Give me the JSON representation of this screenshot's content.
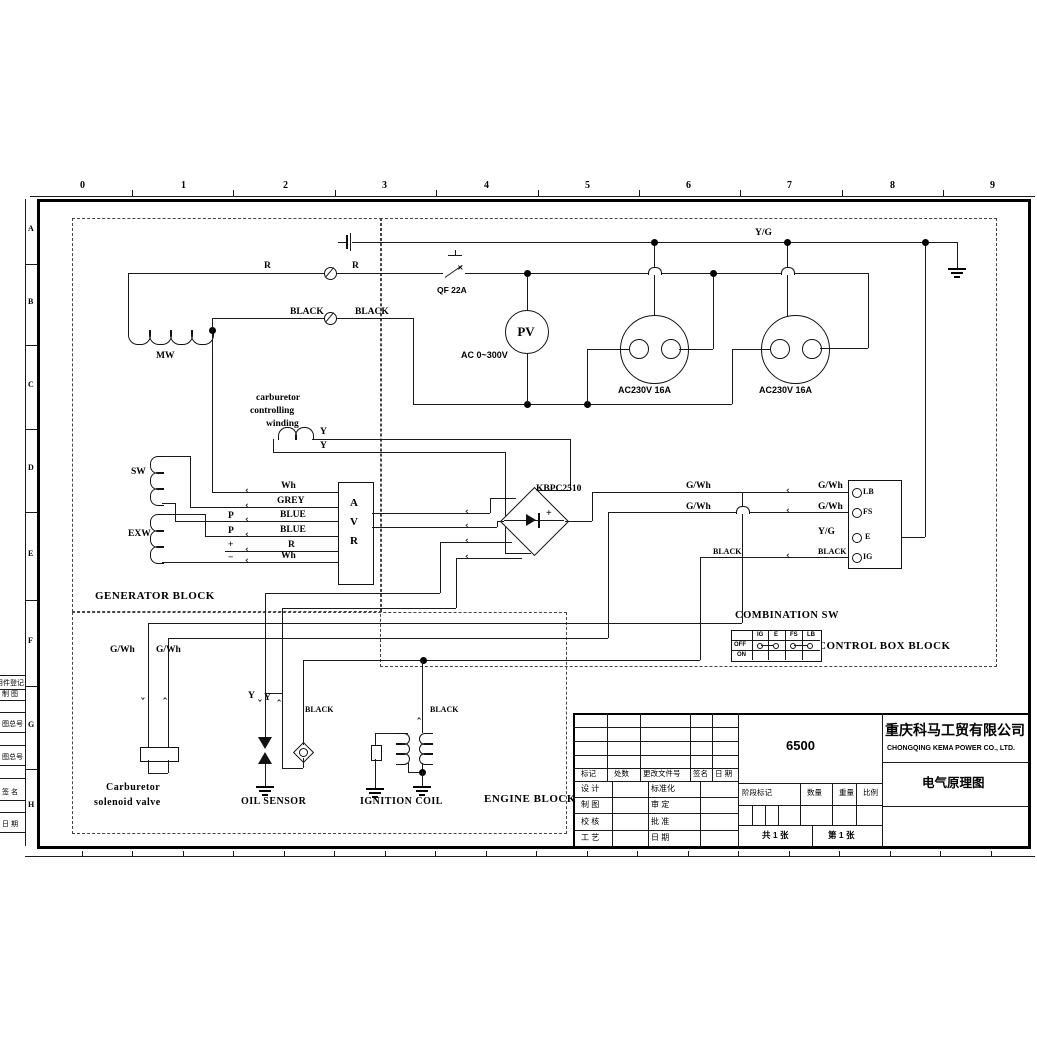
{
  "sheet": {
    "ruler_cols": [
      "0",
      "1",
      "2",
      "3",
      "4",
      "5",
      "6",
      "7",
      "8",
      "9"
    ],
    "ruler_rows": [
      "A",
      "B",
      "C",
      "D",
      "E",
      "F",
      "G",
      "H"
    ],
    "margin_notes": [
      "用件登记",
      "制 图",
      "图总号",
      "图总号",
      "签 名",
      "日 期"
    ]
  },
  "blocks": {
    "generator": "GENERATOR BLOCK",
    "control": "CONTROL BOX BLOCK",
    "engine": "ENGINE BLOCK"
  },
  "labels": {
    "r1": "R",
    "r2": "R",
    "black1": "BLACK",
    "black2": "BLACK",
    "yg_bus": "Y/G",
    "qf": "QF 22A",
    "pv": "PV",
    "ac_range": "AC 0~300V",
    "outlet1": "AC230V 16A",
    "outlet2": "AC230V 16A",
    "mw": "MW",
    "sw": "SW",
    "exw": "EXW",
    "carb_w1": "carburetor",
    "carb_w2": "controlling",
    "carb_w3": "winding",
    "y_top": "Y",
    "y_bot": "Y",
    "wh1": "Wh",
    "grey": "GREY",
    "blue1": "BLUE",
    "blue2": "BLUE",
    "r3": "R",
    "wh2": "Wh",
    "p1": "P",
    "p2": "P",
    "plus": "+",
    "minus": "−",
    "avr_a": "A",
    "avr_v": "V",
    "avr_r": "R",
    "kbpc": "KBPC2510",
    "rect_plus": "+",
    "gwh1": "G/Wh",
    "gwh2": "G/Wh",
    "gwh3": "G/Wh",
    "gwh4": "G/Wh",
    "yg_e": "Y/G",
    "black_ig1": "BLACK",
    "black_ig2": "BLACK",
    "gwh5": "G/Wh",
    "gwh6": "G/Wh",
    "y_oil1": "Y",
    "y_oil2": "Y",
    "black_oil": "BLACK",
    "black_ign": "BLACK",
    "carb1": "Carburetor",
    "carb2": "solenoid valve",
    "oil": "OIL SENSOR",
    "ign": "IGNITION COIL"
  },
  "terminal_block": {
    "t1": "LB",
    "t2": "FS",
    "t3": "E",
    "t4": "IG"
  },
  "combination_sw": {
    "title": "COMBINATION SW",
    "cols": [
      "IG",
      "E",
      "FS",
      "LB"
    ],
    "rows": [
      "OFF",
      "ON"
    ]
  },
  "title_block": {
    "rev_header": [
      "标记",
      "处数",
      "更改文件号",
      "签名",
      "日 期"
    ],
    "rows": [
      [
        "设 计",
        "标准化"
      ],
      [
        "制 图",
        "审 定"
      ],
      [
        "校 核",
        "批 准"
      ],
      [
        "工 艺",
        "日 期"
      ]
    ],
    "model": "6500",
    "stage": [
      "阶段标记",
      "数量",
      "重量",
      "比例"
    ],
    "total": "共 1 张",
    "no": "第 1 张",
    "company_cn": "重庆科马工贸有限公司",
    "company_en": "CHONGQING KEMA POWER CO., LTD.",
    "doc_title": "电气原理图"
  }
}
